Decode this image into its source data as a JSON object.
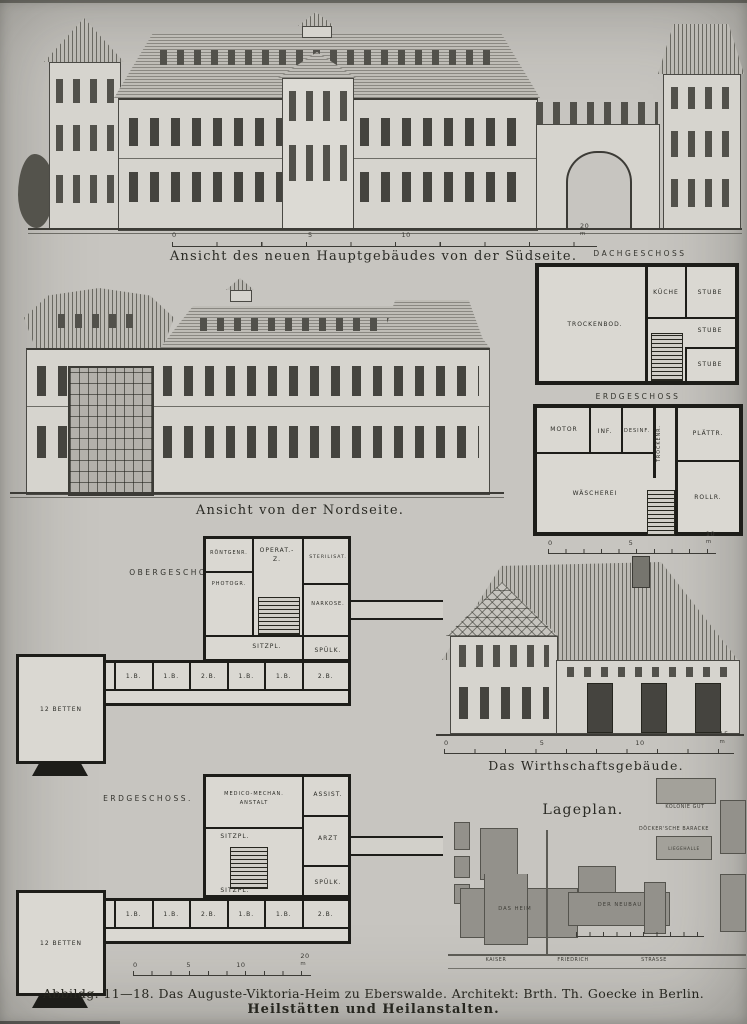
{
  "south": {
    "caption": "Ansicht des neuen Hauptgebäudes von der Südseite.",
    "scale": {
      "t0": "0",
      "t1": "5",
      "t2": "10",
      "t3": "20",
      "unit": "m"
    }
  },
  "north": {
    "caption": "Ansicht von der Nordseite."
  },
  "dach": {
    "title": "DACHGESCHOSS",
    "trockenbod": "TROCKENBOD.",
    "kueche": "KÜCHE",
    "stube1": "STUBE",
    "stube2": "STUBE",
    "stube3": "STUBE"
  },
  "erdg_r": {
    "title": "ERDGESCHOSS",
    "motor": "MOTOR",
    "inf": "INF.",
    "desinf": "DESINF.",
    "trockenr": "TROCKENR.",
    "plaettr": "PLÄTTR.",
    "waescherei": "WÄSCHEREI",
    "rollr": "ROLLR.",
    "scale": {
      "t0": "0",
      "t1": "5",
      "t2": "10",
      "unit": "m"
    }
  },
  "oberg": {
    "title": "OBERGESCHOSS.",
    "roentgen": "RÖNTGENR.",
    "operat1": "OPERAT.-",
    "operat2": "Z.",
    "sterilisat": "STERILISAT.",
    "photogr": "PHOTOGR.",
    "narkose": "NARKOSE.",
    "sitzpl": "SITZPL.",
    "spuelk": "SPÜLK.",
    "schwest": "SCHWEST.",
    "betten": "12 BETTEN",
    "beds": [
      "1.B.",
      "1.B.",
      "1.B.",
      "1.B.",
      "2.B.",
      "1.B.",
      "1.B.",
      "2.B."
    ]
  },
  "wirtschaft": {
    "caption": "Das Wirthschaftsgebäude.",
    "scale": {
      "t0": "0",
      "t1": "5",
      "t2": "10",
      "t3": "15",
      "unit": "m"
    }
  },
  "erdg_l": {
    "title": "ERDGESCHOSS.",
    "medico1": "MEDICO-MECHAN.",
    "medico2": "ANSTALT",
    "assist": "ASSIST.",
    "arzt": "ARZT",
    "sitzpl1": "SITZPL.",
    "sitzpl2": "SITZPL.",
    "spuelk": "SPÜLK.",
    "schwest": "SCHWEST.",
    "betten": "12 BETTEN",
    "beds": [
      "1.B.",
      "1.B.",
      "1.B.",
      "1.B.",
      "2.B.",
      "1.B.",
      "1.B.",
      "2.B."
    ],
    "scale": {
      "t0": "0",
      "t1": "5",
      "t2": "10",
      "t3": "20",
      "unit": "m"
    }
  },
  "lageplan": {
    "title": "Lageplan.",
    "kolonie": "KOLONIE GUT",
    "baracke": "DÖCKER'SCHE BARACKE",
    "liegehalle": "LIEGEHALLE",
    "altes": "DAS HEIM",
    "neues": "DER NEUBAU",
    "street1": "KAISER",
    "street2": "FRIEDRICH",
    "street3": "STRASSE"
  },
  "footer": {
    "line1": "Abbildg. 11—18.  Das Auguste-Viktoria-Heim zu Eberswalde.  Architekt: Brth. Th. Goecke in Berlin.",
    "line2": "Heilstätten und Heilanstalten."
  }
}
